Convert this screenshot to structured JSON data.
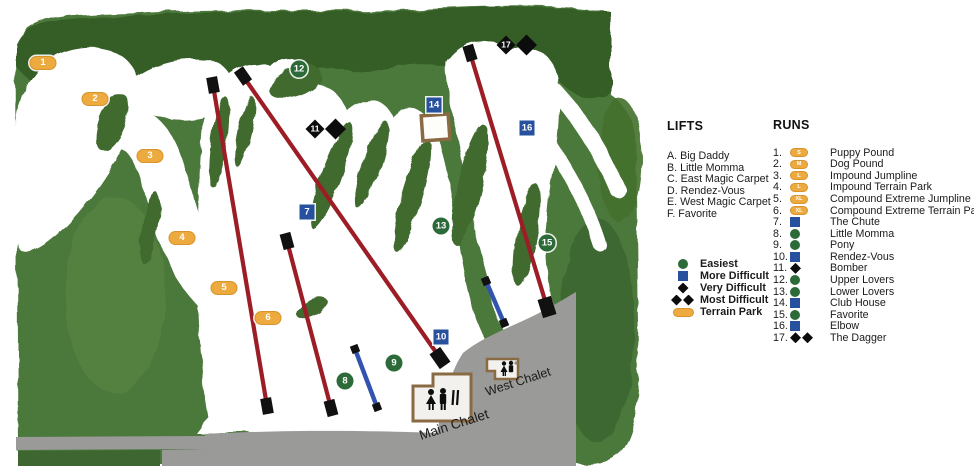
{
  "map": {
    "chalets": {
      "main": "Main Chalet",
      "west": "West Chalet"
    },
    "markers": [
      {
        "n": "1",
        "type": "park",
        "x": 43,
        "y": 63
      },
      {
        "n": "2",
        "type": "park",
        "x": 95,
        "y": 99
      },
      {
        "n": "3",
        "type": "park",
        "x": 150,
        "y": 156
      },
      {
        "n": "4",
        "type": "park",
        "x": 182,
        "y": 238
      },
      {
        "n": "5",
        "type": "park",
        "x": 224,
        "y": 288
      },
      {
        "n": "6",
        "type": "park",
        "x": 268,
        "y": 318
      },
      {
        "n": "7",
        "type": "blue",
        "x": 307,
        "y": 212
      },
      {
        "n": "8",
        "type": "green",
        "x": 345,
        "y": 381
      },
      {
        "n": "9",
        "type": "green",
        "x": 394,
        "y": 363
      },
      {
        "n": "10",
        "type": "blue",
        "x": 441,
        "y": 337
      },
      {
        "n": "11",
        "type": "diamond2",
        "x": 315,
        "y": 129
      },
      {
        "n": "12",
        "type": "green",
        "x": 299,
        "y": 69
      },
      {
        "n": "13",
        "type": "green",
        "x": 441,
        "y": 226
      },
      {
        "n": "14",
        "type": "blue",
        "x": 434,
        "y": 105
      },
      {
        "n": "15",
        "type": "green",
        "x": 547,
        "y": 243
      },
      {
        "n": "16",
        "type": "blue",
        "x": 527,
        "y": 128
      },
      {
        "n": "17",
        "type": "diamond2",
        "x": 506,
        "y": 45
      }
    ]
  },
  "legend": {
    "lifts_title": "LIFTS",
    "lifts": [
      "A. Big Daddy",
      "B. Little Momma",
      "C. East Magic Carpet",
      "D. Rendez-Vous",
      "E. West Magic Carpet",
      "F. Favorite"
    ],
    "difficulty": [
      {
        "sym": "green",
        "label": "Easiest"
      },
      {
        "sym": "blue",
        "label": "More Difficult"
      },
      {
        "sym": "diamond",
        "label": "Very Difficult"
      },
      {
        "sym": "diamond2",
        "label": "Most Difficult"
      },
      {
        "sym": "park",
        "label": "Terrain Park"
      }
    ],
    "runs_title": "RUNS",
    "runs": [
      {
        "num": "1.",
        "sym": "park",
        "letter": "S",
        "label": "Puppy Pound"
      },
      {
        "num": "2.",
        "sym": "park",
        "letter": "M",
        "label": "Dog Pound"
      },
      {
        "num": "3.",
        "sym": "park",
        "letter": "L",
        "label": "Impound Jumpline"
      },
      {
        "num": "4.",
        "sym": "park",
        "letter": "L",
        "label": "Impound Terrain Park"
      },
      {
        "num": "5.",
        "sym": "park",
        "letter": "XL",
        "label": "Compound Extreme Jumpline"
      },
      {
        "num": "6.",
        "sym": "park",
        "letter": "XL",
        "label": "Compound Extreme Terrain Park"
      },
      {
        "num": "7.",
        "sym": "blue",
        "label": "The Chute"
      },
      {
        "num": "8.",
        "sym": "green",
        "label": "Little Momma"
      },
      {
        "num": "9.",
        "sym": "green",
        "label": "Pony"
      },
      {
        "num": "10.",
        "sym": "blue",
        "label": "Rendez-Vous"
      },
      {
        "num": "11.",
        "sym": "diamond",
        "label": "Bomber"
      },
      {
        "num": "12.",
        "sym": "green",
        "label": "Upper Lovers"
      },
      {
        "num": "13.",
        "sym": "green",
        "label": "Lower Lovers"
      },
      {
        "num": "14.",
        "sym": "blue",
        "label": "Club House"
      },
      {
        "num": "15.",
        "sym": "green",
        "label": "Favorite"
      },
      {
        "num": "16.",
        "sym": "blue",
        "label": "Elbow"
      },
      {
        "num": "17.",
        "sym": "diamond2",
        "label": "The Dagger"
      }
    ]
  },
  "colors": {
    "easiest": "#2c6b39",
    "more_difficult": "#27509e",
    "most_difficult": "#0c0c0c",
    "terrain_park": "#edaa3e",
    "chairlift_line": "#9c1d26",
    "magic_carpet_line": "#3353b0"
  }
}
